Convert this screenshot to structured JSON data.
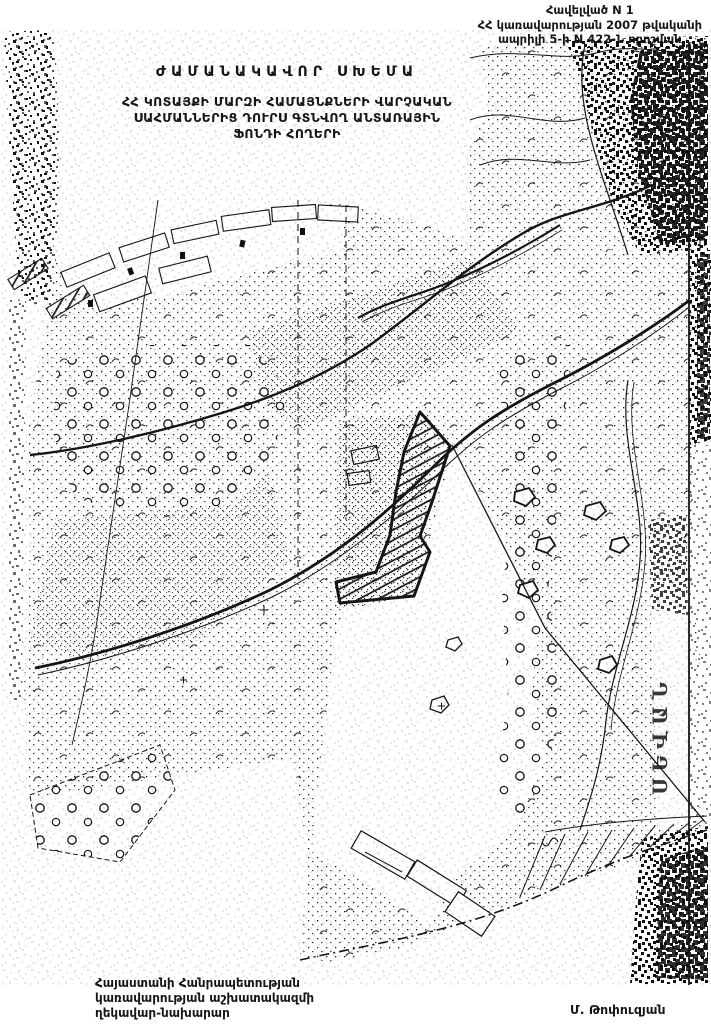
{
  "page": {
    "paper": "#ffffff",
    "ink": "#151515"
  },
  "header": {
    "line1": "Հավելված N 1",
    "line2": "ՀՀ կառավարության 2007 թվականի",
    "line3": "ապրիլի 5-ի N 422-Ն որոշման"
  },
  "title": {
    "line1": "ԺԱՄԱՆԱԿԱՎՈՐ ՍԽԵՄԱ",
    "line2": "ՀՀ ԿՈՏԱՅՔԻ ՄԱՐԶԻ ՀԱՄԱՅՆՔՆԵՐԻ ՎԱՐՉԱԿԱՆ",
    "line3": "ՍԱՀՄԱՆՆԵՐԻՑ ԴՈՒՐՍ ԳՏՆՎՈՂ ԱՆՏԱՌԱՅԻՆ",
    "line4": "ՖՈՆԴԻ ՀՈՂԵՐԻ"
  },
  "map": {
    "vertical_label": "ՍԵՎԱՆ"
  },
  "footer": {
    "left_line1": "Հայաստանի Հանրապետության",
    "left_line2": "կառավարության աշխատակազմի",
    "left_line3": "ղեկավար-նախարար",
    "signature": "Մ. Թոփուզյան"
  }
}
